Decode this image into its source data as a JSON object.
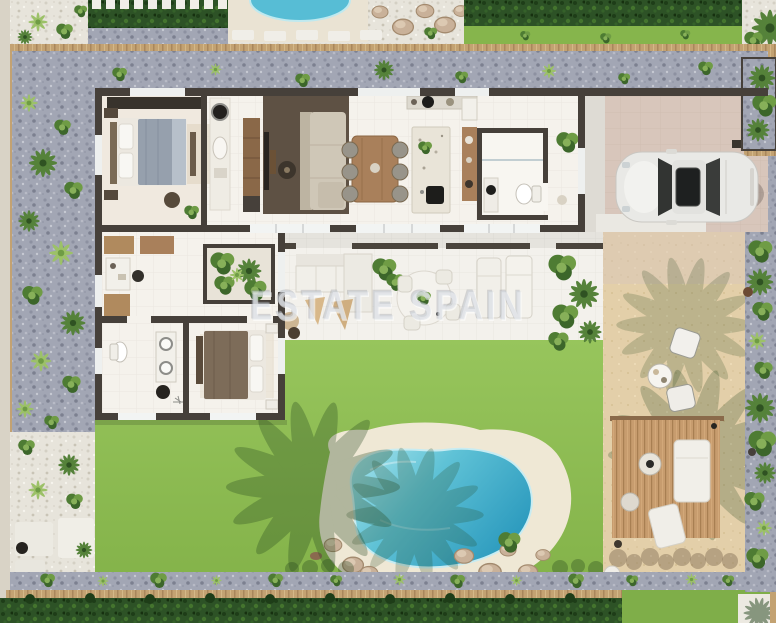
{
  "watermark": {
    "text": "ESTATE SPAIN"
  },
  "scene": {
    "type": "top-down-3d-floor-plan-render",
    "subject": "single-storey villa plot with garden, swimming pool, sun deck and driveway parking",
    "areas": [
      "neighboring-plot",
      "perimeter-hedge",
      "perimeter-fence",
      "gravel-border-garden",
      "master-bedroom",
      "utility-corridor",
      "living-room",
      "dining-area",
      "kitchen-island",
      "guest-bathroom",
      "entry-hall",
      "front-porch",
      "driveway",
      "parked-car",
      "covered-terrace",
      "courtyard-planter",
      "outdoor-lounge",
      "outdoor-dining-table",
      "sun-loungers",
      "hallway",
      "second-bathroom",
      "second-bedroom",
      "lawn",
      "swimming-pool",
      "pool-surround",
      "rock-landscaping",
      "stepping-stones",
      "sand-terrace",
      "wooden-deck",
      "daybed",
      "bistro-set"
    ]
  },
  "palette": {
    "lawn": "#8cbc51",
    "lawn_bright": "#97c55c",
    "hedge": "#2d5226",
    "gravel_blue": "#a2a6b4",
    "gravel_white": "#e7e4db",
    "fence": "#c3a272",
    "wall": "#46403a",
    "tile": "#f5f2ec",
    "wood_floor": "#5e5144",
    "terrace": "#f3f1ec",
    "driveway": "#d8c6bb",
    "porch": "#dedbd4",
    "sand": "#e3cfa9",
    "deck": "#c79c6e",
    "pool_sand": "#efe8d5",
    "pool_light": "#a8e4ec",
    "pool_mid": "#5fc2d6",
    "pool_deep": "#2e9cbf",
    "car": "#e9e9e6",
    "wood_furniture": "#a9805b",
    "sofa": "#cfc7b7",
    "white_furniture": "#f1efe9"
  }
}
